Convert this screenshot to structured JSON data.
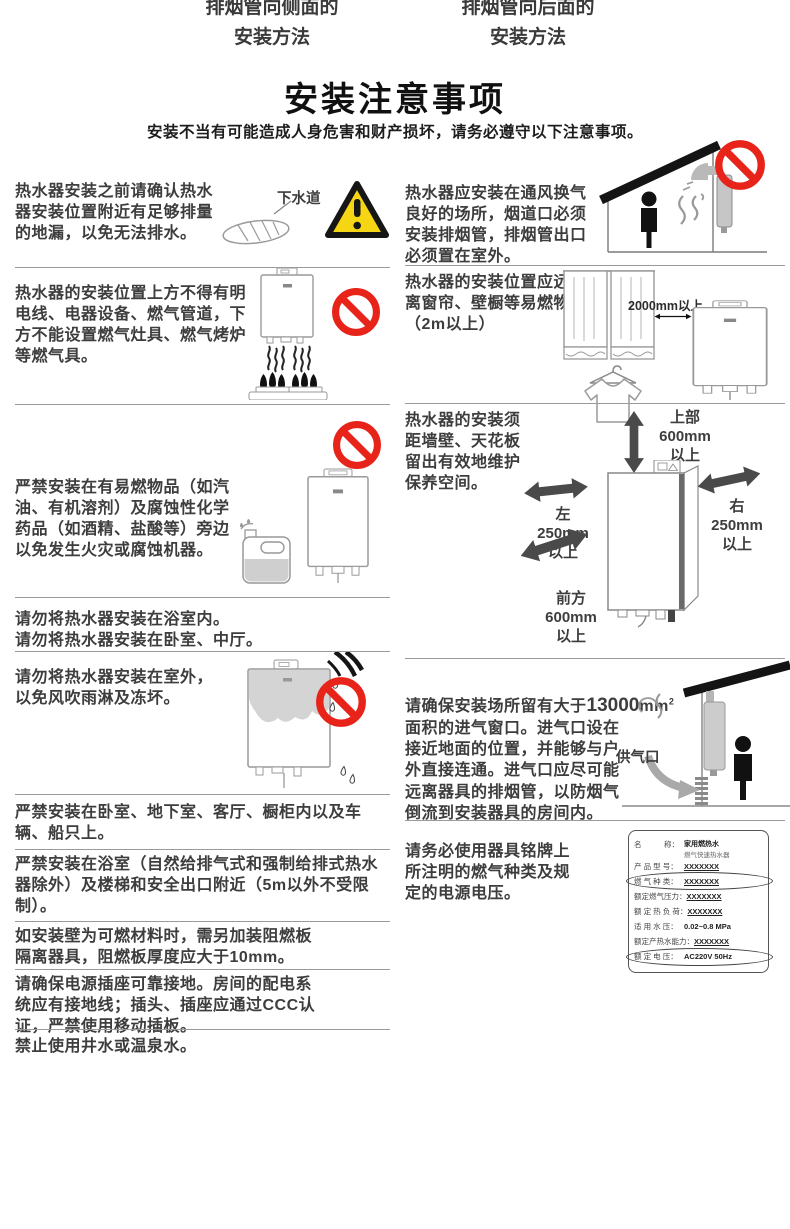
{
  "header": {
    "left_line1": "排烟管向侧面的",
    "left_line2": "安装方法",
    "right_line1": "排烟管向后面的",
    "right_line2": "安装方法"
  },
  "title": "安装注意事项",
  "subtitle": "安装不当有可能造成人身危害和财产损坏，请务必遵守以下注意事项。",
  "colors": {
    "prohibition_red": "#e8231a",
    "warning_yellow": "#f6d515",
    "body_text": "#3d3d3d",
    "divider_gray": "#9a9a9a"
  },
  "icons": {
    "prohibition": "red-circle-with-diagonal-slash",
    "warning": "yellow-triangle-exclamation"
  },
  "left": {
    "item1": {
      "text": "热水器安装之前请确认热水\n器安装位置附近有足够排量\n的地漏，以免无法排水。",
      "drain_label": "下水道"
    },
    "item2": {
      "text": "热水器的安装位置上方不得有明\n电线、电器设备、燃气管道，下\n方不能设置燃气灶具、燃气烤炉\n等燃气具。"
    },
    "item3": {
      "text": "严禁安装在有易燃物品（如汽\n油、有机溶剂）及腐蚀性化学\n药品（如酒精、盐酸等）旁边\n以免发生火灾或腐蚀机器。"
    },
    "item4": {
      "text": "请勿将热水器安装在浴室内。\n请勿将热水器安装在卧室、中厅。"
    },
    "item5": {
      "text": "请勿将热水器安装在室外，\n以免风吹雨淋及冻坏。"
    },
    "item6": {
      "text": "严禁安装在卧室、地下室、客厅、橱柜内以及车\n辆、船只上。"
    },
    "item7": {
      "text": "严禁安装在浴室（自然给排气式和强制给排式热水\n器除外）及楼梯和安全出口附近（5m以外不受限\n制）。"
    },
    "item8": {
      "text": "如安装壁为可燃材料时，需另加装阻燃板\n隔离器具，阻燃板厚度应大于10mm。"
    },
    "item9": {
      "text": "请确保电源插座可靠接地。房间的配电系\n统应有接地线；插头、插座应通过CCC认\n证，严禁使用移动插板。"
    },
    "item10": {
      "text": "禁止使用井水或温泉水。"
    }
  },
  "right": {
    "item1": {
      "text": "热水器应安装在通风换气\n良好的场所，烟道口必须\n安装排烟管，排烟管出口\n必须置在室外。"
    },
    "item2": {
      "text": "热水器的安装位置应远\n离窗帘、壁橱等易燃物。\n（2m以上）",
      "distance_label": "2000mm以上"
    },
    "item3": {
      "text": "热水器的安装须\n距墙壁、天花板\n留出有效地维护\n保养空间。",
      "clearance_top": "上部\n600mm\n以上",
      "clearance_left": "左\n250mm\n以上",
      "clearance_right": "右\n250mm\n以上",
      "clearance_front": "前方\n600mm\n以上"
    },
    "item4": {
      "text_before": "请确保安装场所留有大于",
      "text_bold": "13000",
      "text_unit": "mm",
      "text_sup": "2",
      "text_after": "\n面积的进气窗口。进气口设在\n接近地面的位置，并能够与户\n外直接连通。进气口应尽可能\n远离器具的排烟管，以防烟气\n倒流到安装器具的房间内。",
      "supply_label": "供气口"
    },
    "item5": {
      "text": "请务必使用器具铭牌上\n所注明的燃气种类及规\n定的电源电压。"
    }
  },
  "nameplate": {
    "rows": [
      {
        "label": "名　　　称：",
        "value": "家用燃热水",
        "value2": "燃气快速热水器"
      },
      {
        "label": "产 品 型 号：",
        "value": "XXXXXXX"
      },
      {
        "label": "燃 气 种 类：",
        "value": "XXXXXXX"
      },
      {
        "label": "额定燃气压力：",
        "value": "XXXXXXX"
      },
      {
        "label": "额 定 热 负 荷：",
        "value": "XXXXXXX"
      },
      {
        "label": "适 用 水 压：",
        "value": "0.02~0.8 MPa"
      },
      {
        "label": "额定产热水能力：",
        "value": "XXXXXXX"
      },
      {
        "label": "额 定 电 压：",
        "value": "AC220V 50Hz"
      }
    ]
  }
}
